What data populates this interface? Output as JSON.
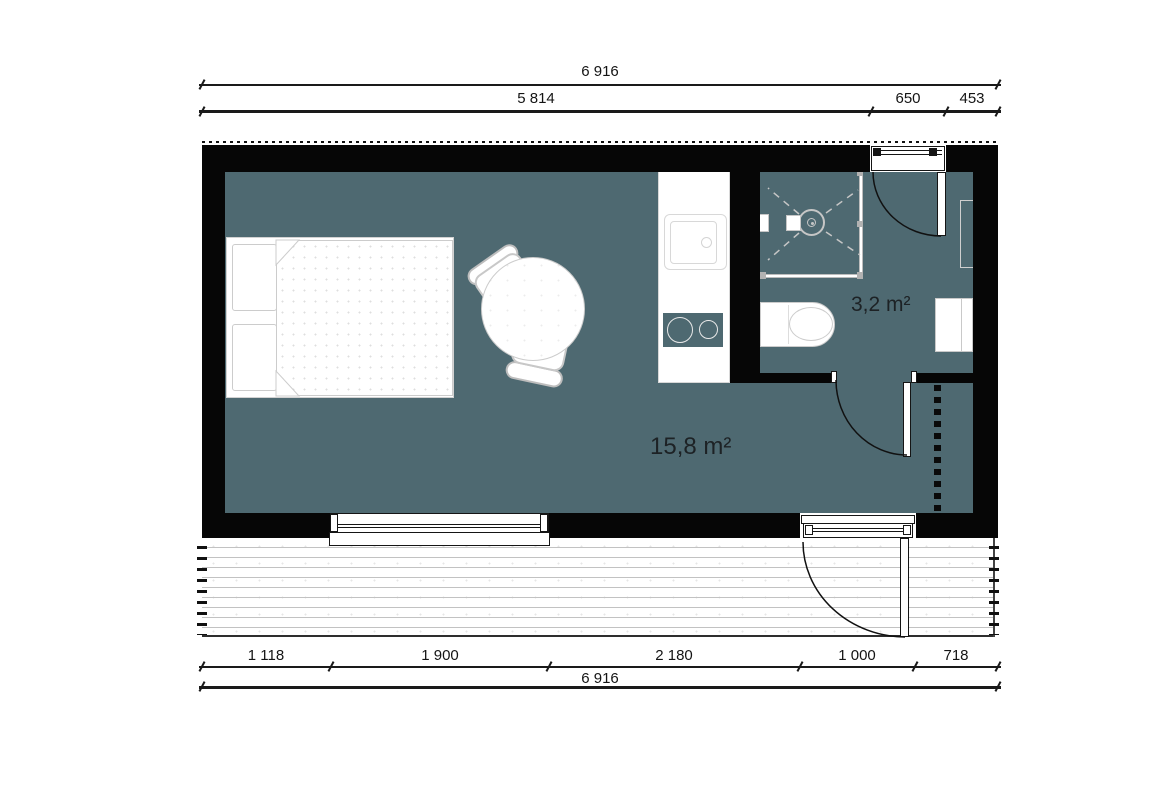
{
  "drawing": {
    "type": "floor-plan",
    "areas": {
      "main_room": "15,8 m²",
      "bathroom": "3,2 m²"
    },
    "dimensions": {
      "top_total": "6 916",
      "top_segments": [
        "5 814",
        "650",
        "453"
      ],
      "bottom_segments": [
        "1 118",
        "1 900",
        "2 180",
        "1 000",
        "718"
      ],
      "bottom_total": "6 916"
    },
    "colors": {
      "wall": "#060606",
      "floor": "#4e6971",
      "fixture_outline": "#cccccc",
      "dimension_ink": "#1a1a1a"
    }
  }
}
